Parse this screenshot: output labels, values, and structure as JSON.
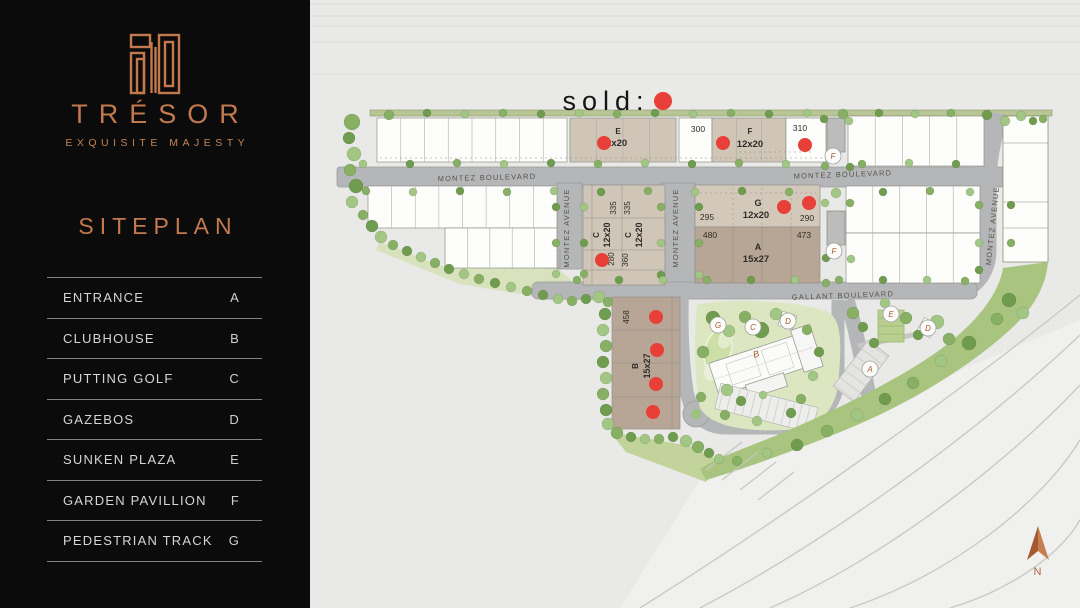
{
  "sidebar": {
    "brand": "TRÉSOR",
    "tagline": "EXQUISITE MAJESTY",
    "title": "SITEPLAN",
    "legend": [
      {
        "label": "ENTRANCE",
        "key": "A"
      },
      {
        "label": "CLUBHOUSE",
        "key": "B"
      },
      {
        "label": "PUTTING GOLF",
        "key": "C"
      },
      {
        "label": "GAZEBOS",
        "key": "D"
      },
      {
        "label": "SUNKEN PLAZA",
        "key": "E"
      },
      {
        "label": "GARDEN PAVILLION",
        "key": "F"
      },
      {
        "label": "PEDESTRIAN TRACK",
        "key": "G"
      }
    ]
  },
  "map": {
    "colors": {
      "accent": "#c1794d",
      "sold_red": "#e84038",
      "block_tan": "#d0c6b7",
      "block_dark_tan": "#b7a695",
      "road": "#b5b6b8",
      "marker_letter": "#a8562c"
    },
    "labels": [
      {
        "name": "sold-label",
        "text": "sold:",
        "x": 606,
        "y": 110,
        "size": 27,
        "ls": 6,
        "color": "#141414"
      },
      {
        "name": "road-label-montez-boulevard-west",
        "text": "MONTEZ BOULEVARD",
        "x": 487,
        "y": 180,
        "rot": -1.5,
        "size": 7.5,
        "ls": 1.2,
        "color": "#55534b"
      },
      {
        "name": "road-label-montez-boulevard-east",
        "text": "MONTEZ BOULEVARD",
        "x": 843,
        "y": 177,
        "rot": -2,
        "size": 7.5,
        "ls": 1.2,
        "color": "#55534b"
      },
      {
        "name": "road-label-montez-avenue-west",
        "text": "MONTEZ AVENUE",
        "x": 569,
        "y": 228,
        "rot": -90,
        "size": 7.5,
        "ls": 1.2,
        "color": "#55534b"
      },
      {
        "name": "road-label-montez-avenue-mid",
        "text": "MONTEZ AVENUE",
        "x": 678,
        "y": 228,
        "rot": -90,
        "size": 7.5,
        "ls": 1.2,
        "color": "#55534b"
      },
      {
        "name": "road-label-montez-avenue-east",
        "text": "MONTEZ AVENUE",
        "x": 995,
        "y": 226,
        "rot": -84,
        "size": 7.5,
        "ls": 1.2,
        "color": "#55534b"
      },
      {
        "name": "road-label-gallant-boulevard",
        "text": "GALLANT BOULEVARD",
        "x": 843,
        "y": 298,
        "rot": -2,
        "size": 7.5,
        "ls": 1.2,
        "color": "#55534b"
      },
      {
        "name": "block-e-name",
        "text": "E",
        "x": 618,
        "y": 134,
        "size": 8,
        "bold": 1
      },
      {
        "name": "block-e-size",
        "text": "12x20",
        "x": 614,
        "y": 146,
        "size": 9.5,
        "bold": 1
      },
      {
        "name": "plot-300",
        "text": "300",
        "x": 698,
        "y": 132,
        "size": 8.5
      },
      {
        "name": "block-f-name",
        "text": "F",
        "x": 750,
        "y": 134,
        "size": 8,
        "bold": 1
      },
      {
        "name": "block-f-size",
        "text": "12x20",
        "x": 750,
        "y": 147,
        "size": 9.5,
        "bold": 1
      },
      {
        "name": "plot-310",
        "text": "310",
        "x": 800,
        "y": 131,
        "size": 8.5
      },
      {
        "name": "block-g-name",
        "text": "G",
        "x": 758,
        "y": 206,
        "size": 9,
        "bold": 1
      },
      {
        "name": "block-g-size",
        "text": "12x20",
        "x": 756,
        "y": 218,
        "size": 9.5,
        "bold": 1
      },
      {
        "name": "plot-295",
        "text": "295",
        "x": 707,
        "y": 220,
        "size": 8.5
      },
      {
        "name": "plot-290",
        "text": "290",
        "x": 807,
        "y": 221,
        "size": 8.5
      },
      {
        "name": "plot-480",
        "text": "480",
        "x": 710,
        "y": 238,
        "size": 8.5
      },
      {
        "name": "plot-473",
        "text": "473",
        "x": 804,
        "y": 238,
        "size": 8.5
      },
      {
        "name": "block-a-name",
        "text": "A",
        "x": 758,
        "y": 250,
        "size": 9,
        "bold": 1
      },
      {
        "name": "block-a-size",
        "text": "15x27",
        "x": 756,
        "y": 262,
        "size": 9.5,
        "bold": 1
      },
      {
        "name": "plot-335-a",
        "text": "335",
        "x": 616,
        "y": 208,
        "rot": -90,
        "size": 8
      },
      {
        "name": "plot-335-b",
        "text": "335",
        "x": 630,
        "y": 208,
        "rot": -90,
        "size": 8
      },
      {
        "name": "block-c-name-a",
        "text": "C",
        "x": 599,
        "y": 235,
        "rot": -90,
        "size": 8,
        "bold": 1
      },
      {
        "name": "block-c-size-a",
        "text": "12x20",
        "x": 610,
        "y": 235,
        "rot": -90,
        "size": 9,
        "bold": 1
      },
      {
        "name": "block-c-name-b",
        "text": "C",
        "x": 631,
        "y": 235,
        "rot": -90,
        "size": 8,
        "bold": 1
      },
      {
        "name": "block-c-size-b",
        "text": "12x20",
        "x": 642,
        "y": 235,
        "rot": -90,
        "size": 9,
        "bold": 1
      },
      {
        "name": "plot-280",
        "text": "280",
        "x": 614,
        "y": 259,
        "rot": -90,
        "size": 8
      },
      {
        "name": "plot-360",
        "text": "360",
        "x": 628,
        "y": 260,
        "rot": -90,
        "size": 8
      },
      {
        "name": "plot-458",
        "text": "458",
        "x": 629,
        "y": 317,
        "rot": -90,
        "size": 8
      },
      {
        "name": "block-b-name",
        "text": "B",
        "x": 638,
        "y": 366,
        "rot": -90,
        "size": 8,
        "bold": 1
      },
      {
        "name": "block-b-size",
        "text": "15x27",
        "x": 650,
        "y": 366,
        "rot": -90,
        "size": 9,
        "bold": 1
      },
      {
        "name": "clubhouse-label",
        "text": "B",
        "x": 757,
        "y": 357,
        "rot": -18,
        "size": 9,
        "italic": 1,
        "serif": 1,
        "color": "#a8562c"
      },
      {
        "name": "north-label",
        "text": "N",
        "x": 1038,
        "y": 575,
        "size": 11,
        "color": "#b06a3e",
        "ls": 1
      }
    ],
    "markers": [
      {
        "letter": "F",
        "x": 833,
        "y": 156
      },
      {
        "letter": "F",
        "x": 834,
        "y": 251
      },
      {
        "letter": "G",
        "x": 718,
        "y": 325
      },
      {
        "letter": "C",
        "x": 753,
        "y": 327
      },
      {
        "letter": "D",
        "x": 788,
        "y": 321
      },
      {
        "letter": "E",
        "x": 891,
        "y": 314
      },
      {
        "letter": "D",
        "x": 928,
        "y": 328
      },
      {
        "letter": "A",
        "x": 870,
        "y": 369
      }
    ],
    "sold_dots": [
      {
        "x": 663,
        "y": 101,
        "r": 9
      },
      {
        "x": 604,
        "y": 143,
        "r": 7
      },
      {
        "x": 723,
        "y": 143,
        "r": 7
      },
      {
        "x": 805,
        "y": 145,
        "r": 7
      },
      {
        "x": 784,
        "y": 207,
        "r": 7
      },
      {
        "x": 809,
        "y": 203,
        "r": 7
      },
      {
        "x": 602,
        "y": 260,
        "r": 7
      },
      {
        "x": 656,
        "y": 317,
        "r": 7
      },
      {
        "x": 657,
        "y": 350,
        "r": 7
      },
      {
        "x": 656,
        "y": 384,
        "r": 7
      },
      {
        "x": 653,
        "y": 412,
        "r": 7
      }
    ]
  }
}
